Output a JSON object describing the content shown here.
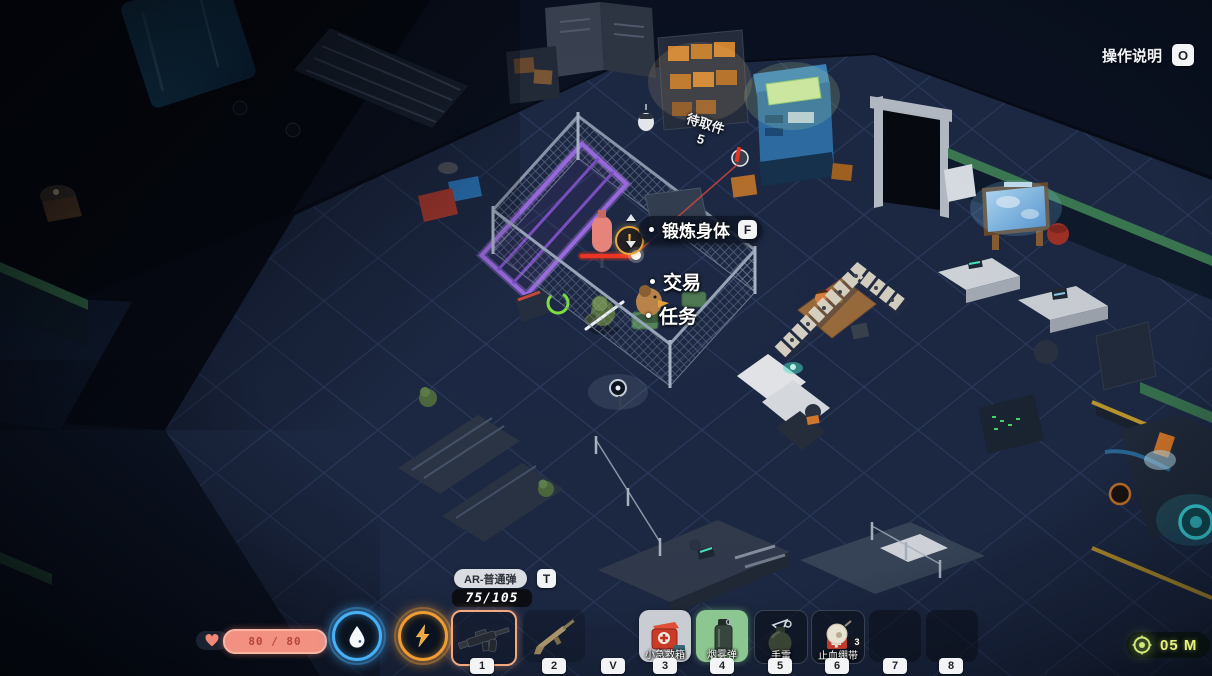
{
  "hud": {
    "help": {
      "label": "操作说明",
      "key": "O"
    },
    "interaction_menu": [
      {
        "label": "锻炼身体",
        "key": "F",
        "selected": true
      },
      {
        "label": "交易",
        "selected": false
      },
      {
        "label": "任务",
        "selected": false
      }
    ],
    "quest_marker": "!",
    "pickup": {
      "label": "待取件",
      "count": "5"
    },
    "health": {
      "display": "80 / 80",
      "current": 80,
      "max": 80
    },
    "resources": [
      {
        "icon": "water-drop-icon",
        "color": "#48b0f6"
      },
      {
        "icon": "lightning-bolt-icon",
        "color": "#ef9c33"
      }
    ],
    "weapon": {
      "name": "AR-普通弹",
      "swap_key": "T",
      "ammo": "75/105"
    },
    "hotbar": [
      {
        "key": "1",
        "icon": "assault-rifle-icon",
        "selected": true
      },
      {
        "key": "2",
        "icon": "rifle-icon"
      },
      {
        "key": "V",
        "icon": ""
      },
      {
        "key": "3",
        "label": "小急救箱",
        "icon": "first-aid-kit-icon"
      },
      {
        "key": "4",
        "label": "烟雾弹",
        "icon": "smoke-grenade-icon",
        "highlighted": true
      },
      {
        "key": "5",
        "label": "手雷",
        "icon": "grenade-icon"
      },
      {
        "key": "6",
        "label": "止血绷带",
        "icon": "bandage-icon",
        "count": "3"
      },
      {
        "key": "7",
        "icon": ""
      },
      {
        "key": "8",
        "icon": ""
      }
    ],
    "objective": {
      "distance": "05 M",
      "icon": "extraction-marker-icon"
    }
  },
  "colors": {
    "selected_slot_border": "#f3a97d",
    "highlight_green": "#8cc690",
    "laser_red": "#ea3524",
    "health_fill": "#f29181",
    "objective_text": "#e9f07e",
    "menu_pill": "#0f1728"
  }
}
